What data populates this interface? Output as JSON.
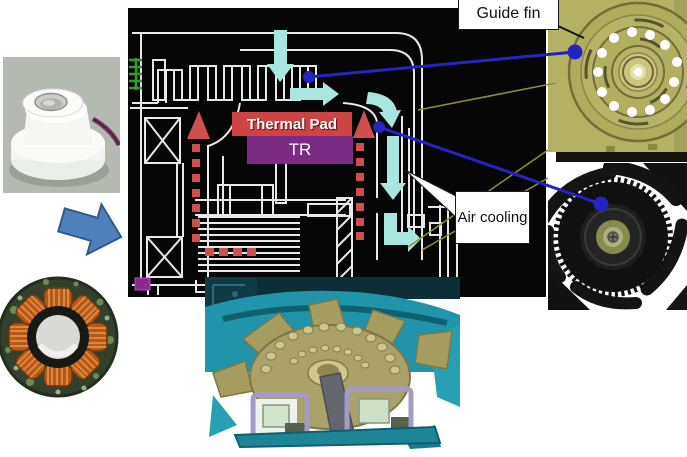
{
  "figure": {
    "labels": {
      "guide_fin": "Guide fin",
      "air_cooling": "Air cooling",
      "thermal_pad": "Thermal Pad",
      "transistor": "TR"
    },
    "colors": {
      "diagram_background": "#060606",
      "diagram_line": "#e8e8e8",
      "airflow_arrow": "#a9e6df",
      "heat_arrow": "#cf4f4f",
      "thermal_pad_bg": "#ce4343",
      "tr_bg": "#7c2b84",
      "callout_blue": "#2424be",
      "callout_olive": "#8f8f3f",
      "guide_fin_body": "#b5b163",
      "process_arrow_blue": "#4f81bd",
      "coil_copper": "#b35a1a",
      "cad_teal": "#1f94aa"
    },
    "images": {
      "insulator_photo": "insulator-part-photo",
      "stator_photo": "stator-coil-photo",
      "guide_fin_render": "guide-fin-render",
      "fan_photo": "cooling-fan-photo",
      "fan_assembly_render": "fan-assembly-render"
    }
  }
}
